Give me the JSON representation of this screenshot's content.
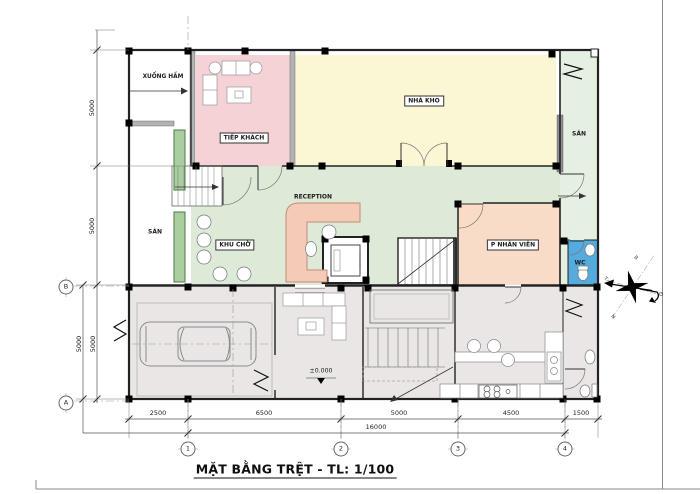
{
  "title": "MẶT BẰNG TRỆT - TL: 1/100",
  "rooms": {
    "xuong_ham": "XUỐNG HẦM",
    "tiep_khach": "TIẾP KHÁCH",
    "nha_kho": "NHÀ KHO",
    "san_left": "SÂN",
    "san_right": "SÂN",
    "reception": "RECEPTION",
    "khu_cho": "KHU CHỜ",
    "p_nhan_vien": "P NHÂN VIÊN",
    "wc": "WC"
  },
  "annotations": {
    "level": "±0.000"
  },
  "dimensions": {
    "horizontal": {
      "d1": "2500",
      "d2": "6500",
      "d3": "5000",
      "d4": "4500",
      "d5": "1500",
      "total": "16000"
    },
    "vertical": {
      "v1": "5000",
      "v2": "5000",
      "v3": "5000",
      "v4": "5000"
    }
  },
  "grid": {
    "c1": "1",
    "c2": "2",
    "c3": "3",
    "c4": "4",
    "rB": "B",
    "rA": "A"
  },
  "compass": {
    "n": "B",
    "w": "T",
    "s": "N",
    "e": "Đ"
  },
  "colors": {
    "tiep_khach": "#f4d2d6",
    "nha_kho": "#fbf6d4",
    "reception": "#dcead7",
    "san": "#e6f0e2",
    "p_nhan_vien": "#f8dcc8",
    "wc": "#55aade",
    "garage": "#eae6e6",
    "planter": "#a9cfa0",
    "counter": "#f5cab6"
  }
}
